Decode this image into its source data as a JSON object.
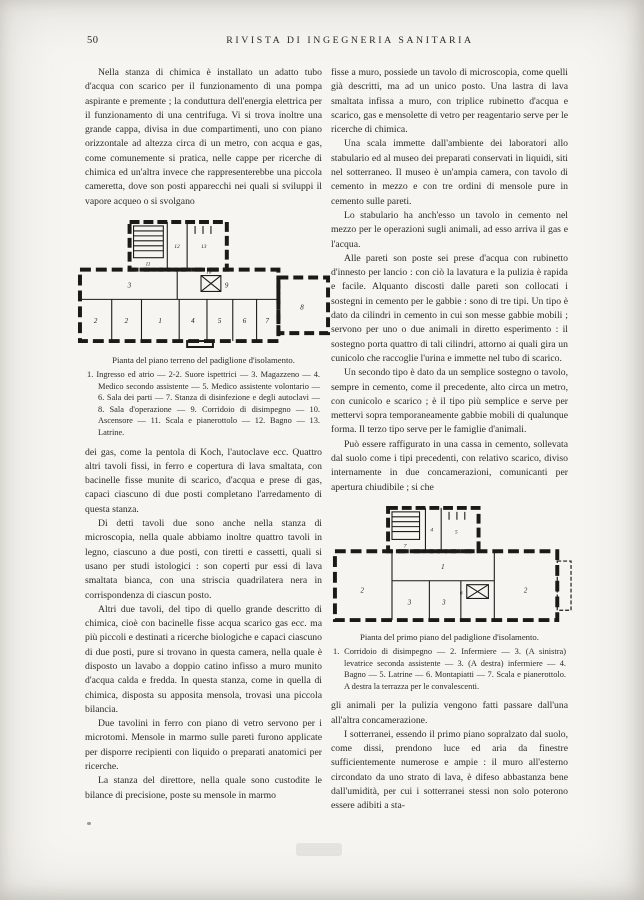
{
  "page": {
    "number": "50",
    "journal_title": "RIVISTA DI INGEGNERIA SANITARIA"
  },
  "colors": {
    "paper": "#f6f5f1",
    "ink": "#2c2a26",
    "plan_ink": "#1b1a17"
  },
  "left_column": {
    "p1": "Nella stanza di chimica è installato un adatto tubo d'acqua con scarico per il funzionamento di una pompa aspirante e premente ; la conduttura dell'energia elettrica per il funzionamento di una centrifuga. Vi si trova inoltre una grande cappa, divisa in due compartimenti, uno con piano orizzontale ad altezza circa di un metro, con acqua e gas, come comunemente si pratica, nelle cappe per ricerche di chimica ed un'altra invece che rappresenterebbe una piccola cameretta, dove son posti apparecchi nei quali si sviluppi il vapore acqueo o si svolgano",
    "p2": "dei gas, come la pentola di Koch, l'autoclave ecc. Quattro altri tavoli fissi, in ferro e copertura di lava smaltata, con bacinelle fisse munite di scarico, d'acqua e prese di gas, capaci ciascuno di due posti completano l'arredamento di questa stanza.",
    "p3": "Di detti tavoli due sono anche nella stanza di microscopia, nella quale abbiamo inoltre quattro tavoli in legno, ciascuno a due posti, con tiretti e cassetti, quali si usano per studi istologici : son coperti pur essi di lava smaltata bianca, con una striscia quadrilatera nera in corrispondenza di ciascun posto.",
    "p4": "Altri due tavoli, del tipo di quello grande descritto di chimica, cioè con bacinelle fisse acqua scarico gas ecc. ma più piccoli e destinati a ricerche biologiche e capaci ciascuno di due posti, pure si trovano in questa camera, nella quale è disposto un lavabo a doppio catino infisso a muro munito d'acqua calda e fredda. In questa stanza, come in quella di chimica, disposta su apposita mensola, trovasi una piccola bilancia.",
    "p5": "Due tavolini in ferro con piano di vetro servono per i microtomi. Mensole in marmo sulle pareti furono applicate per disporre recipienti con liquido o preparati anatomici per ricerche.",
    "p6": "La stanza del direttore, nella quale sono custodite le bilance di precisione, poste su mensole in marmo"
  },
  "figure_ground_floor": {
    "caption_title": "Pianta del piano terreno del padiglione d'isolamento.",
    "legend": "1. Ingresso ed atrio — 2-2. Suore ispettrici — 3. Magazzeno — 4. Medico secondo assistente — 5. Medico assistente volontario — 6. Sala dei parti — 7. Stanza di disinfezione e degli autoclavi — 8. Sala d'operazione — 9. Corridoio di disimpegno — 10. Ascensore — 11. Scala e pianerottolo — 12. Bagno — 13. Latrine.",
    "room_labels": {
      "ingresso": "1",
      "suore_a": "2",
      "suore_b": "2",
      "magazzeno": "3",
      "medico_secondo": "4",
      "medico_volontario": "5",
      "sala_parti": "6",
      "disinfezione": "7",
      "sala_operazione": "8",
      "corridoio": "9",
      "ascensore": "10",
      "scala": "11",
      "bagno": "12",
      "latrine": "13"
    }
  },
  "right_column": {
    "p1": "fisse a muro, possiede un tavolo di microscopia, come quelli già descritti, ma ad un unico posto. Una lastra di lava smaltata infissa a muro, con triplice rubinetto d'acqua e scarico, gas e mensolette di vetro per reagentario serve per le ricerche di chimica.",
    "p2": "Una scala immette dall'ambiente dei laboratori allo stabulario ed al museo dei preparati conservati in liquidi, siti nel sotterraneo. Il museo è un'ampia camera, con tavolo di cemento in mezzo e con tre ordini di mensole pure in cemento sulle pareti.",
    "p3": "Lo stabulario ha anch'esso un tavolo in cemento nel mezzo per le operazioni sugli animali, ad esso arriva il gas e l'acqua.",
    "p4": "Alle pareti son poste sei prese d'acqua con rubinetto d'innesto per lancio : con ciò la lavatura e la pulizia è rapida e facile. Alquanto discosti dalle pareti son collocati i sostegni in cemento per le gabbie : sono di tre tipi. Un tipo è dato da cilindri in cemento in cui son messe gabbie mobili ; servono per uno o due animali in diretto esperimento : il sostegno porta quattro di tali cilindri, attorno ai quali gira un cunicolo che raccoglie l'urina e immette nel tubo di scarico.",
    "p5": "Un secondo tipo è dato da un semplice sostegno o tavolo, sempre in cemento, come il precedente, alto circa un metro, con cunicolo e scarico ; è il tipo più semplice e serve per mettervi sopra temporaneamente gabbie mobili di qualunque forma. Il terzo tipo serve per le famiglie d'animali.",
    "p6": "Può essere raffigurato in una cassa in cemento, sollevata dal suolo come i tipi precedenti, con relativo scarico, diviso internamente in due concamerazioni, comunicanti per apertura chiudibile ; si che",
    "p7": "gli animali per la pulizia vengono fatti passare dall'una all'altra concamerazione.",
    "p8": "I sotterranei, essendo il primo piano sopralzato dal suolo, come dissi, prendono luce ed aria da finestre sufficientemente numerose e ampie : il muro all'esterno circondato da uno strato di lava, è difeso abbastanza bene dall'umidità, per cui i sotterranei stessi non solo poterono essere adibiti a sta-"
  },
  "figure_first_floor": {
    "caption_title": "Pianta del primo piano del padiglione d'isolamento.",
    "legend": "1. Corridoio di disimpegno — 2. Infermiere — 3. (A sinistra) levatrice seconda assistente — 3. (A destra) infermiere — 4. Bagno — 5. Latrine — 6. Montapiatti — 7. Scala e pianerottolo. A destra la terrazza per le convalescenti.",
    "room_labels": {
      "corridoio": "1",
      "infermiere_sx": "2",
      "infermiere_dx": "2",
      "levatrice": "3",
      "infermiere_piccola": "3",
      "bagno": "4",
      "latrine": "5",
      "montapiatti": "6",
      "scala": "7"
    }
  }
}
